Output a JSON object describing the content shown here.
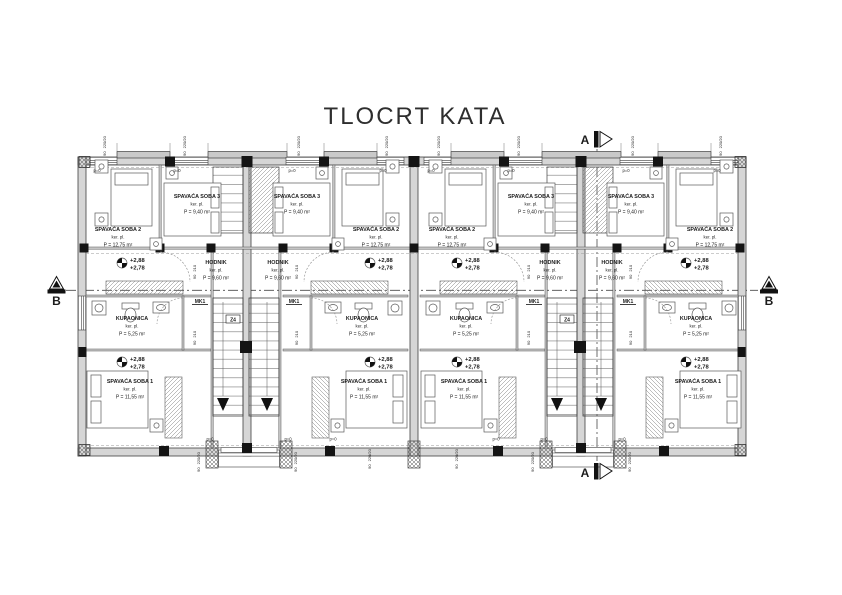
{
  "title": "TLOCRT KATA",
  "section_markers": {
    "a": "A",
    "b": "B"
  },
  "elevation": {
    "upper": "+2,88",
    "lower": "+2,78"
  },
  "stairs": {
    "mark": "MK1",
    "stair_mark": "Z4"
  },
  "parapet_label": "p=0",
  "dims": {
    "window": {
      "w": "90",
      "h": "220/20"
    },
    "door": {
      "w": "90",
      "h": "210"
    }
  },
  "units": [
    {
      "name": "unit-1",
      "rooms": {
        "soba2": {
          "name": "SPAVAĆA SOBA 2",
          "finish": "ker. pl.",
          "area": "P = 12,75 m²"
        },
        "soba3": {
          "name": "SPAVAĆA SOBA 3",
          "finish": "ker. pl.",
          "area": "P = 9,40 m²"
        },
        "hodnik": {
          "name": "HODNIK",
          "finish": "ker. pl.",
          "area": "P = 9,60 m²"
        },
        "kupaonica": {
          "name": "KUPAONICA",
          "finish": "ker. pl.",
          "area": "P = 5,25 m²"
        },
        "soba1": {
          "name": "SPAVAĆA SOBA 1",
          "finish": "ker. pl.",
          "area": "P = 11,55 m²"
        }
      }
    },
    {
      "name": "unit-2",
      "rooms": {
        "soba2": {
          "name": "SPAVAĆA SOBA 2",
          "finish": "ker. pl.",
          "area": "P = 12,75 m²"
        },
        "soba3": {
          "name": "SPAVAĆA SOBA 3",
          "finish": "ker. pl.",
          "area": "P = 9,40 m²"
        },
        "hodnik": {
          "name": "HODNIK",
          "finish": "ker. pl.",
          "area": "P = 9,60 m²"
        },
        "kupaonica": {
          "name": "KUPAONICA",
          "finish": "ker. pl.",
          "area": "P = 5,25 m²"
        },
        "soba1": {
          "name": "SPAVAĆA SOBA 1",
          "finish": "ker. pl.",
          "area": "P = 11,55 m²"
        }
      }
    },
    {
      "name": "unit-3",
      "rooms": {
        "soba2": {
          "name": "SPAVAĆA SOBA 2",
          "finish": "ker. pl.",
          "area": "P = 12,75 m²"
        },
        "soba3": {
          "name": "SPAVAĆA SOBA 3",
          "finish": "ker. pl.",
          "area": "P = 9,40 m²"
        },
        "hodnik": {
          "name": "HODNIK",
          "finish": "ker. pl.",
          "area": "P = 9,60 m²"
        },
        "kupaonica": {
          "name": "KUPAONICA",
          "finish": "ker. pl.",
          "area": "P = 5,25 m²"
        },
        "soba1": {
          "name": "SPAVAĆA SOBA 1",
          "finish": "ker. pl.",
          "area": "P = 11,55 m²"
        }
      }
    },
    {
      "name": "unit-4",
      "rooms": {
        "soba2": {
          "name": "SPAVAĆA SOBA 2",
          "finish": "ker. pl.",
          "area": "P = 12,75 m²"
        },
        "soba3": {
          "name": "SPAVAĆA SOBA 3",
          "finish": "ker. pl.",
          "area": "P = 9,40 m²"
        },
        "hodnik": {
          "name": "HODNIK",
          "finish": "ker. pl.",
          "area": "P = 9,60 m²"
        },
        "kupaonica": {
          "name": "KUPAONICA",
          "finish": "ker. pl.",
          "area": "P = 5,25 m²"
        },
        "soba1": {
          "name": "SPAVAĆA SOBA 1",
          "finish": "ker. pl.",
          "area": "P = 11,55 m²"
        }
      }
    }
  ]
}
